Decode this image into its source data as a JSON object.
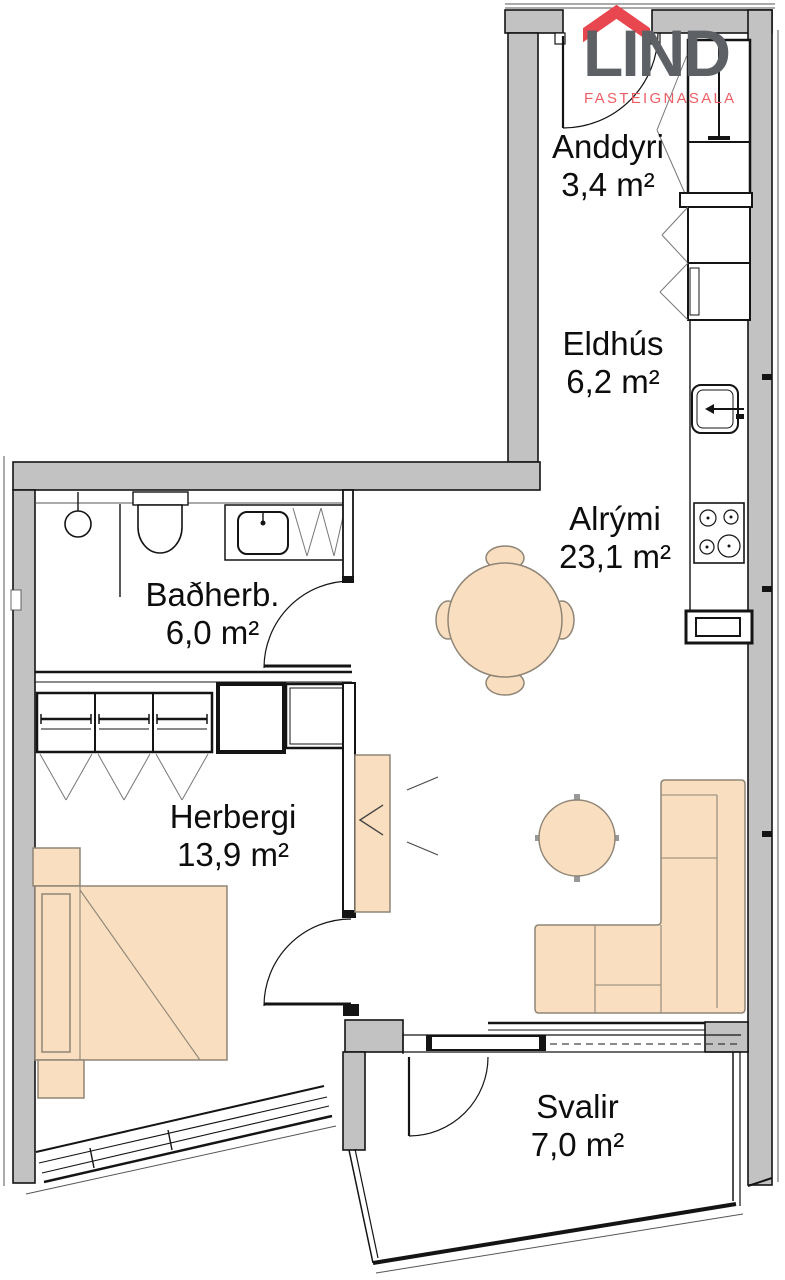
{
  "logo": {
    "name": "LIND",
    "subtitle": "FASTEIGNASALA",
    "roof_color": "#e8474f",
    "name_color": "#5d6165",
    "subtitle_color": "#ee5e65"
  },
  "plan": {
    "wall_color": "#c2c2c2",
    "furniture_fill": "#f9debf",
    "furniture_stroke": "#8f8577",
    "line_color": "#141414"
  },
  "rooms": [
    {
      "name": "Anddyri",
      "area": "3,4 m²"
    },
    {
      "name": "Eldhús",
      "area": "6,2 m²"
    },
    {
      "name": "Alrými",
      "area": "23,1 m²"
    },
    {
      "name": "Baðherb.",
      "area": "6,0 m²"
    },
    {
      "name": "Herbergi",
      "area": "13,9 m²"
    },
    {
      "name": "Svalir",
      "area": "7,0 m²"
    }
  ],
  "fixtures": [
    "entrance-door",
    "entry-closet",
    "kitchen-cabinets",
    "kitchen-sink",
    "stove",
    "radiator",
    "dining-table",
    "dining-chairs",
    "coffee-table",
    "corner-sofa",
    "tv-unit",
    "shower",
    "toilet",
    "bathroom-sink",
    "bathroom-door",
    "wardrobe",
    "storage-closet",
    "bed",
    "nightstand",
    "bedroom-door",
    "bedroom-window",
    "balcony-door",
    "balcony-window"
  ]
}
